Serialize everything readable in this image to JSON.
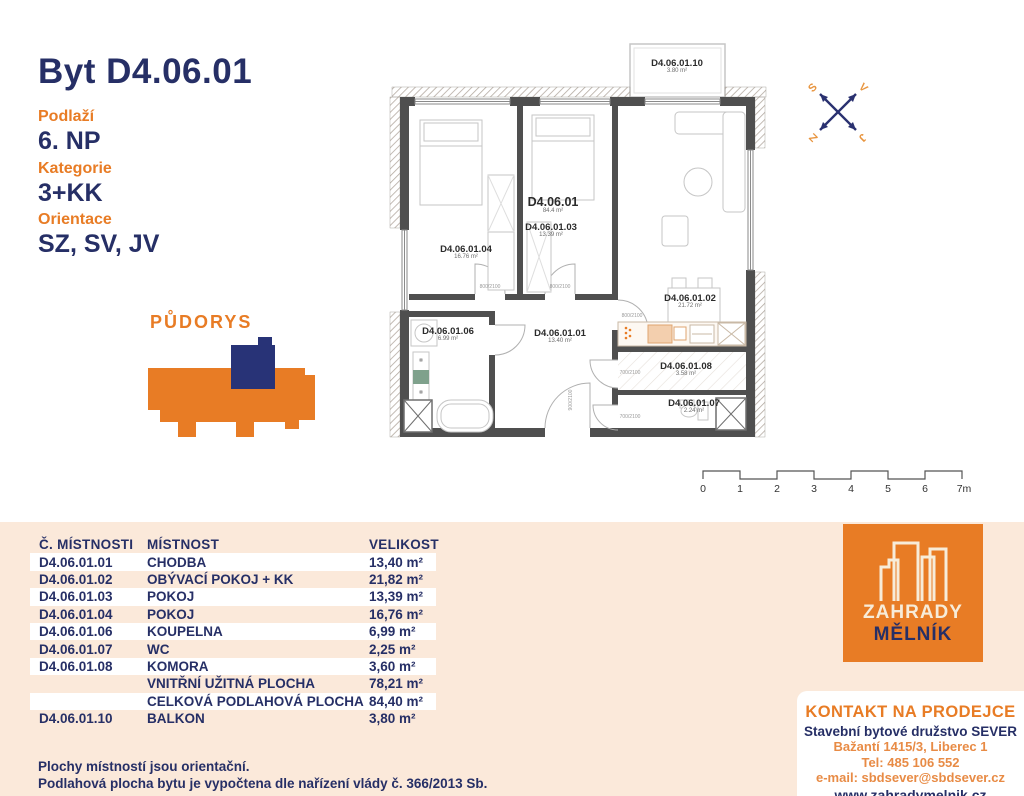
{
  "header": {
    "title": "Byt D4.06.01",
    "attrs": [
      {
        "label": "Podlaží",
        "value": "6. NP"
      },
      {
        "label": "Kategorie",
        "value": "3+KK"
      },
      {
        "label": "Orientace",
        "value": "SZ, SV, JV"
      }
    ]
  },
  "minimap": {
    "title": "PŮDORYS"
  },
  "plan": {
    "apartment": {
      "id": "D4.06.01",
      "area": "84.4 m²"
    },
    "rooms": [
      {
        "id": "D4.06.01.01",
        "area": "13.40 m²"
      },
      {
        "id": "D4.06.01.02",
        "area": "21.72 m²"
      },
      {
        "id": "D4.06.01.03",
        "area": "13.39 m²"
      },
      {
        "id": "D4.06.01.04",
        "area": "16.76 m²"
      },
      {
        "id": "D4.06.01.06",
        "area": "6.99 m²"
      },
      {
        "id": "D4.06.01.07",
        "area": "2.24 m²"
      },
      {
        "id": "D4.06.01.08",
        "area": "3.58 m²"
      },
      {
        "id": "D4.06.01.10",
        "area": "3.80 m²"
      }
    ],
    "door_dims": [
      "800/2100",
      "800/2100",
      "800/2100",
      "700/2100",
      "700/2100",
      "900/2100"
    ]
  },
  "compass": {
    "nw": "S",
    "ne": "V",
    "sw": "Z",
    "se": "J"
  },
  "scalebar": {
    "labels": [
      "0",
      "1",
      "2",
      "3",
      "4",
      "5",
      "6",
      "7m"
    ]
  },
  "table": {
    "headers": [
      "Č. MÍSTNOSTI",
      "MÍSTNOST",
      "VELIKOST"
    ],
    "rows": [
      {
        "id": "D4.06.01.01",
        "name": "CHODBA",
        "size": "13,40 m²"
      },
      {
        "id": "D4.06.01.02",
        "name": "OBÝVACÍ POKOJ + KK",
        "size": "21,82 m²"
      },
      {
        "id": "D4.06.01.03",
        "name": "POKOJ",
        "size": "13,39 m²"
      },
      {
        "id": "D4.06.01.04",
        "name": "POKOJ",
        "size": "16,76 m²"
      },
      {
        "id": "D4.06.01.06",
        "name": "KOUPELNA",
        "size": "6,99 m²"
      },
      {
        "id": "D4.06.01.07",
        "name": "WC",
        "size": "2,25 m²"
      },
      {
        "id": "D4.06.01.08",
        "name": "KOMORA",
        "size": "3,60 m²"
      },
      {
        "id": "",
        "name": "VNITŘNÍ UŽITNÁ PLOCHA",
        "size": "78,21 m²"
      },
      {
        "id": "",
        "name": "CELKOVÁ PODLAHOVÁ PLOCHA",
        "size": "84,40 m²"
      },
      {
        "id": "D4.06.01.10",
        "name": "BALKON",
        "size": "3,80 m²"
      }
    ]
  },
  "footnotes": [
    "Plochy místností jsou orientační.",
    "Podlahová plocha bytu je vypočtena dle nařízení vlády č. 366/2013 Sb."
  ],
  "logo": {
    "line1": "ZAHRADY",
    "line2": "MĚLNÍK"
  },
  "contact": {
    "heading": "KONTAKT NA PRODEJCE",
    "company": "Stavební bytové družstvo SEVER",
    "address": "Bažantí 1415/3, Liberec 1",
    "phone": "Tel: 485 106 552",
    "email": "e-mail: sbdsever@sbdsever.cz",
    "web": "www.zahradymelnik.cz"
  },
  "colors": {
    "navy": "#262f66",
    "orange": "#e87c25",
    "peach": "#fbe9da"
  }
}
